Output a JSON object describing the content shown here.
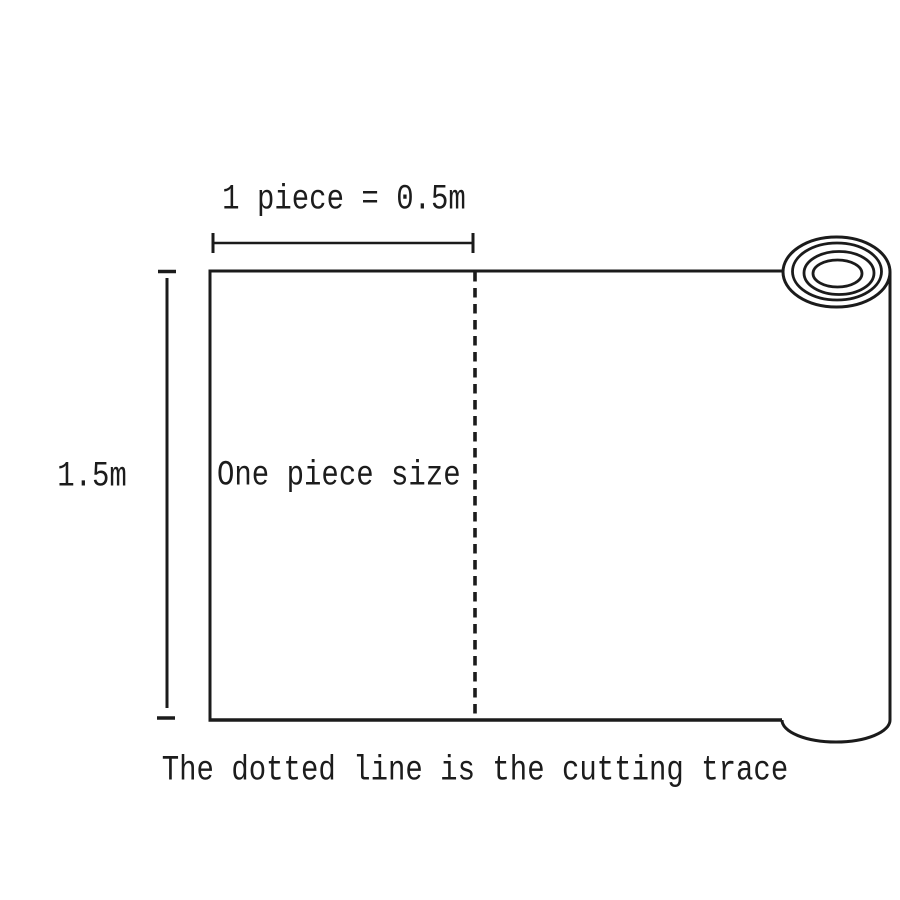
{
  "diagram": {
    "title_hint": "Roll cutting size diagram",
    "top_dimension_label": "1 piece = 0.5m",
    "side_dimension_label": "1.5m",
    "piece_label": "One piece size",
    "caption": "The dotted line is the cutting trace",
    "line_color": "#1b1b1b",
    "background_color": "#ffffff",
    "dimensions": {
      "piece_width_m": "0.5",
      "piece_height_m": "1.5"
    }
  }
}
